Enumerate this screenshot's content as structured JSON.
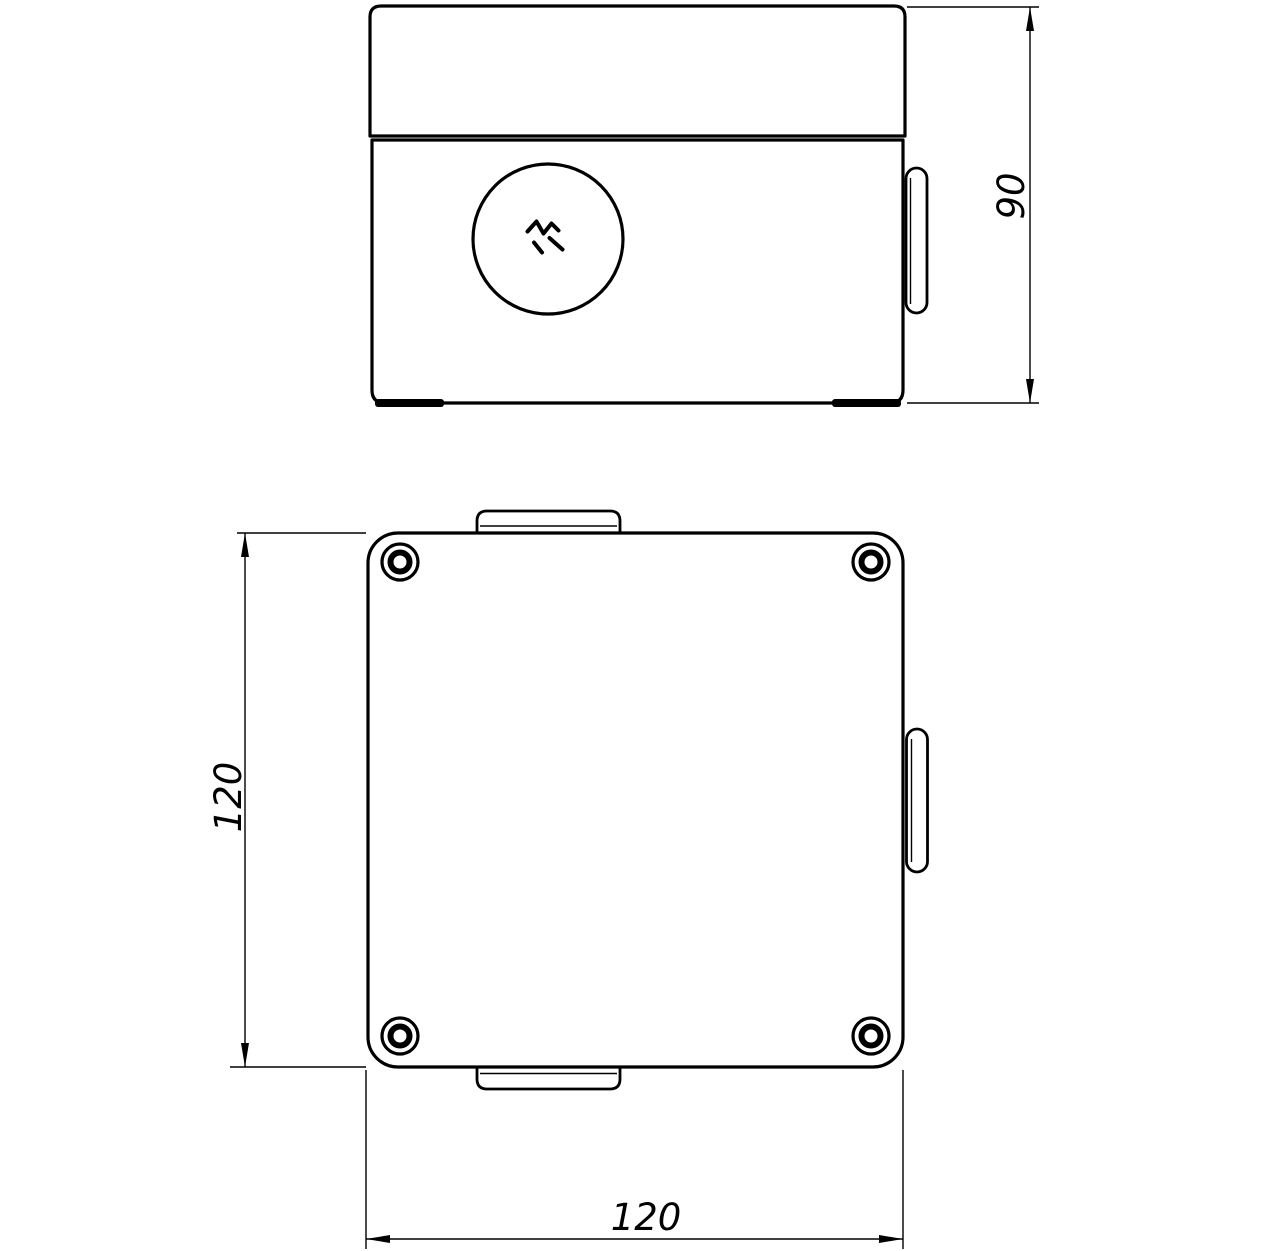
{
  "drawing": {
    "kind": "technical-drawing",
    "colors": {
      "line": "#000000",
      "background": "#ffffff"
    },
    "dimensions": {
      "front_height": {
        "value": 90,
        "label": "90"
      },
      "plan_depth": {
        "value": 120,
        "label": "120"
      },
      "plan_width": {
        "value": 120,
        "label": "120"
      }
    }
  }
}
